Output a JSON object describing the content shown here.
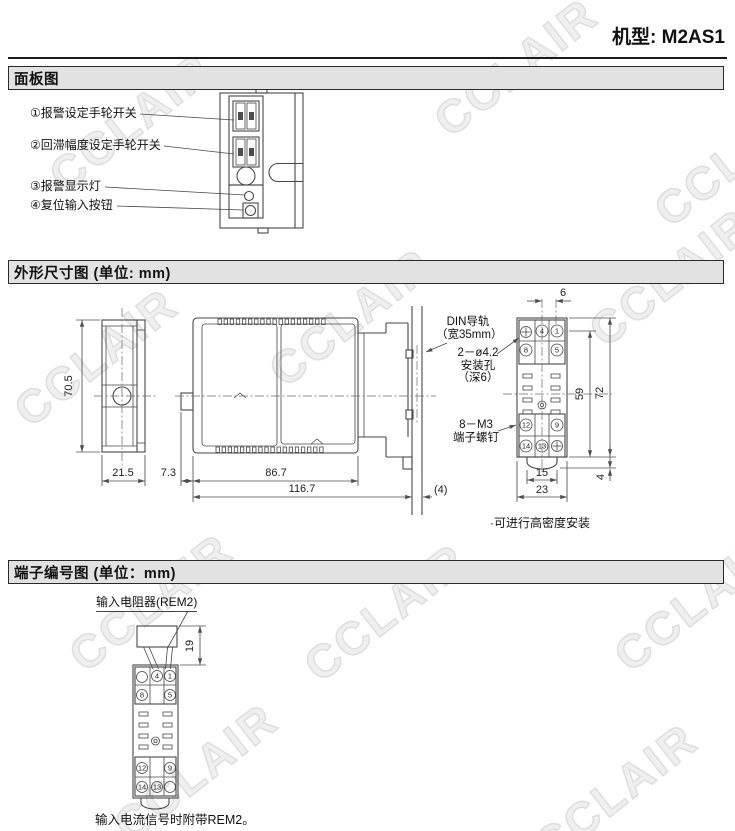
{
  "header": {
    "model": "机型: M2AS1"
  },
  "watermark": {
    "text": "CCLAIR"
  },
  "sections": {
    "panel": {
      "title": "面板图",
      "labels": [
        "①报警设定手轮开关",
        "②回滞幅度设定手轮开关",
        "③报警显示灯",
        "④复位输入按钮"
      ]
    },
    "outline": {
      "title": "外形尺寸图 (单位: mm)",
      "dims": {
        "front_height": "70.5",
        "front_width": "21.5",
        "panel_offset": "7.3",
        "body_width": "86.7",
        "total_width": "116.7",
        "rail_extra": "(4)",
        "hole_pitch": "6",
        "mount_height": "59",
        "socket_height": "72",
        "latch_height": "4",
        "latch_width": "15",
        "socket_width": "23"
      },
      "callouts": {
        "din_1": "DIN导轨",
        "din_2": "（宽35mm）",
        "hole_1": "2－ø4.2",
        "hole_2": "安装孔",
        "hole_3": "（深6）",
        "screw_1": "8－M3",
        "screw_2": "端子螺钉"
      },
      "note": "·可进行高密度安装"
    },
    "terminal": {
      "title": "端子编号图 (单位：mm)",
      "resistor": "输入电阻器(REM2)",
      "resistor_height": "19",
      "footnote": "输入电流信号时附带REM2。"
    }
  },
  "socket": {
    "top": [
      "4",
      "1",
      "8",
      "5"
    ],
    "bottom": [
      "12",
      "9",
      "14",
      "13"
    ]
  }
}
